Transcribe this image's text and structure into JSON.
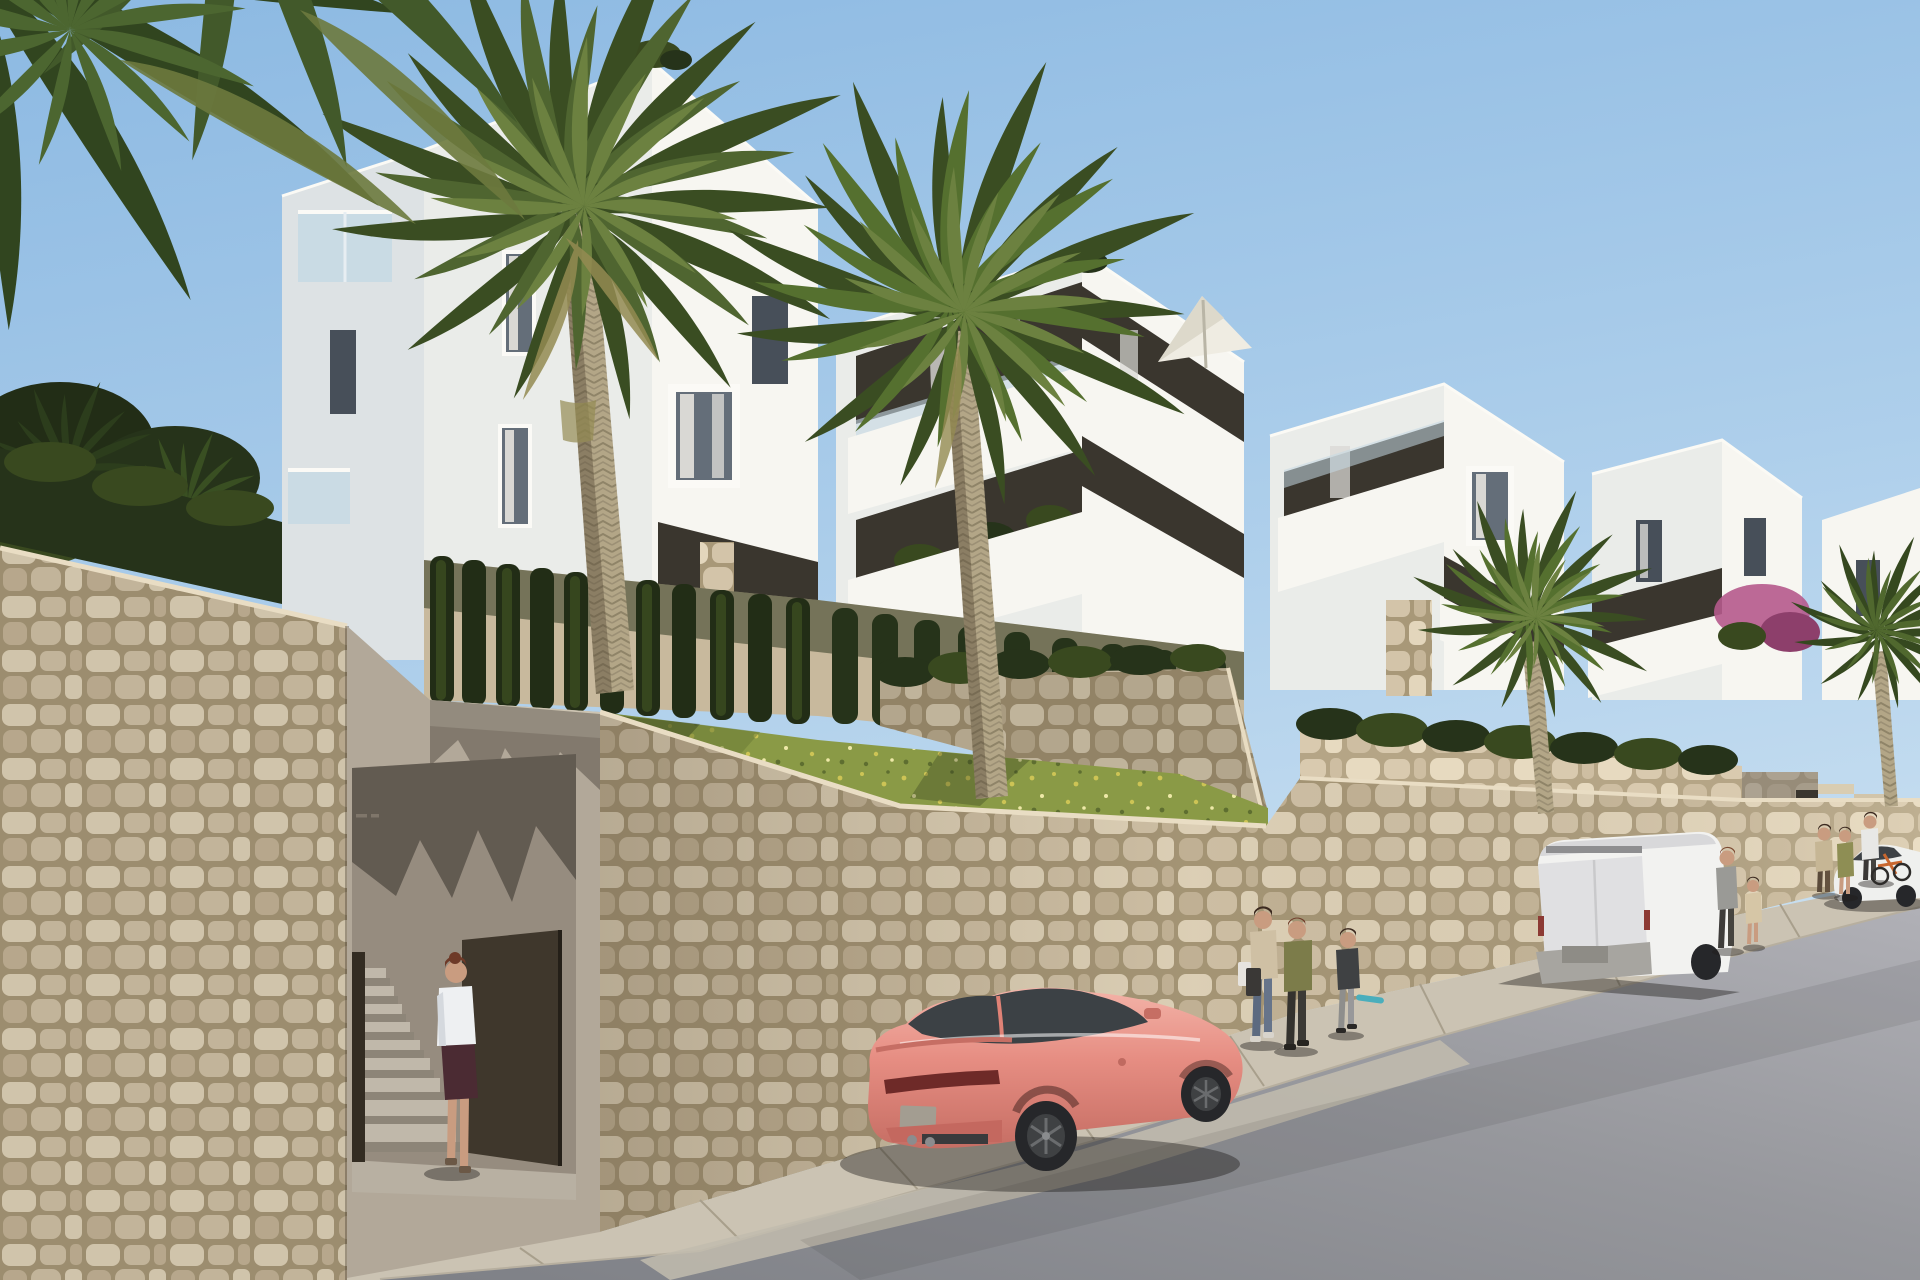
{
  "meta": {
    "kind": "architectural-render",
    "description": "New-build white Mediterranean apartment complex on a hillside street with stone retaining walls, palm trees, a gated pedestrian stair entrance, a coral sports coupe and a white panel van parked on the rising road, and pedestrians on the sidewalk.",
    "lighting": "clear sunny day, sun from upper right"
  },
  "palette": {
    "sky_top": "#8cb9e2",
    "sky_mid": "#aecfeb",
    "sky_low": "#cfe3f2",
    "white_face_bright": "#f7f6f1",
    "white_face_shade": "#eaece9",
    "white_face_dim": "#dde2e4",
    "roof_edge": "#fbfaf5",
    "recess_dark": "#3a362e",
    "recess_mid": "#6b675d",
    "window_glass": "#646e79",
    "window_dark": "#474f59",
    "curtain": "#d9d8d4",
    "frame_white": "#fbfaf6",
    "glass_rail": "#c5d9e4",
    "stone_base": "#d3c4a9",
    "stone_light": "#e3d6bc",
    "stone_mid": "#c6b699",
    "stone_joint": "#a89878",
    "gray_structure": "#8e867a",
    "entrance_wall": "#b2a899",
    "entrance_floor": "#b8b0a2",
    "interior_wall": "#968c7f",
    "gate_brown": "#3f372c",
    "gate_brown2": "#332c22",
    "stair_tread": "#c0b8aa",
    "stair_riser": "#8d8578",
    "hedge_dark": "#26331a",
    "hedge_mid": "#39491f",
    "hedge_light": "#4d6128",
    "ivy_dark": "#222d16",
    "grass_base": "#8a9a46",
    "grass_dark": "#6c7c36",
    "palm_green_dark": "#3a4d22",
    "palm_green": "#4f6530",
    "palm_green_light": "#6c8140",
    "palm_dry": "#948b52",
    "overhang_dark": "#31451f",
    "overhang_mid": "#42592a",
    "trunk_base": "#b3a687",
    "trunk_dark": "#8c8066",
    "sidewalk": "#cbc3b3",
    "sidewalk_line": "#a89f8c",
    "curb_face": "#b7af9f",
    "gutter": "#c2bcae",
    "road_far": "#b0b0b6",
    "road_mid": "#96979c",
    "road_near": "#7e8086",
    "shadow_soft": "rgba(30,28,26,0.42)",
    "car_pink": "#e68d82",
    "car_pink_hi": "#f3b3a8",
    "car_pink_dark": "#c66e64",
    "car_glass": "#3c4145",
    "wheel_dark": "#26272a",
    "wheel_spoke": "#6a6c6e",
    "tail_red": "#6e2a28",
    "plate": "#a39d91",
    "van_white": "#f2f2f0",
    "van_shade": "#e0e0e2",
    "van_dark": "#c4c4c6",
    "bumper": "#a7a5a0",
    "skin": "#c99c80",
    "hair_dark": "#3c2a20",
    "hair_auburn": "#6e3a28",
    "shirt_white": "#eef0f2",
    "skirt_maroon": "#4b2b33",
    "parasol": "#efece2",
    "bougainvillea": "#b55a8c",
    "bike_orange": "#c9672f",
    "skateboard_teal": "#4aaebc"
  },
  "scene": {
    "sky": "clear light-blue sky",
    "buildings": [
      "white-apartment-block-left",
      "white-apartment-block-middle",
      "white-apartment-block-right",
      "white-apartment-block-far-right"
    ],
    "roof_items": [
      "white-parasol-on-terrace",
      "rooftop-shrubs"
    ],
    "vegetation": [
      "overhanging-palm-fronds-top-left",
      "tall-palm-tree-1",
      "tall-palm-tree-2",
      "palm-tree-right",
      "palm-tree-far-right",
      "ivy-columns-on-facade",
      "hedge-rows",
      "grass-slope-with-wildflowers",
      "bougainvillea-pink"
    ],
    "hardscape": [
      "stone-retaining-wall-main",
      "stone-wall-left",
      "pedestrian-entrance-with-stairs",
      "open-metal-gate",
      "sidewalk",
      "asphalt-street",
      "concrete-gutter"
    ],
    "vehicles": [
      "coral-sports-coupe",
      "white-panel-van",
      "white-sedan-distant"
    ],
    "people": [
      "woman-entering-stairs",
      "woman-with-shopping-bags",
      "person-olive-jacket",
      "kid-with-skateboard",
      "man-with-child",
      "couple-standing",
      "cyclist-with-orange-bike"
    ],
    "signs": [
      {
        "name": "entrance-plaque-dark",
        "legible": false
      },
      {
        "name": "small-wall-marking",
        "legible": false
      }
    ]
  }
}
